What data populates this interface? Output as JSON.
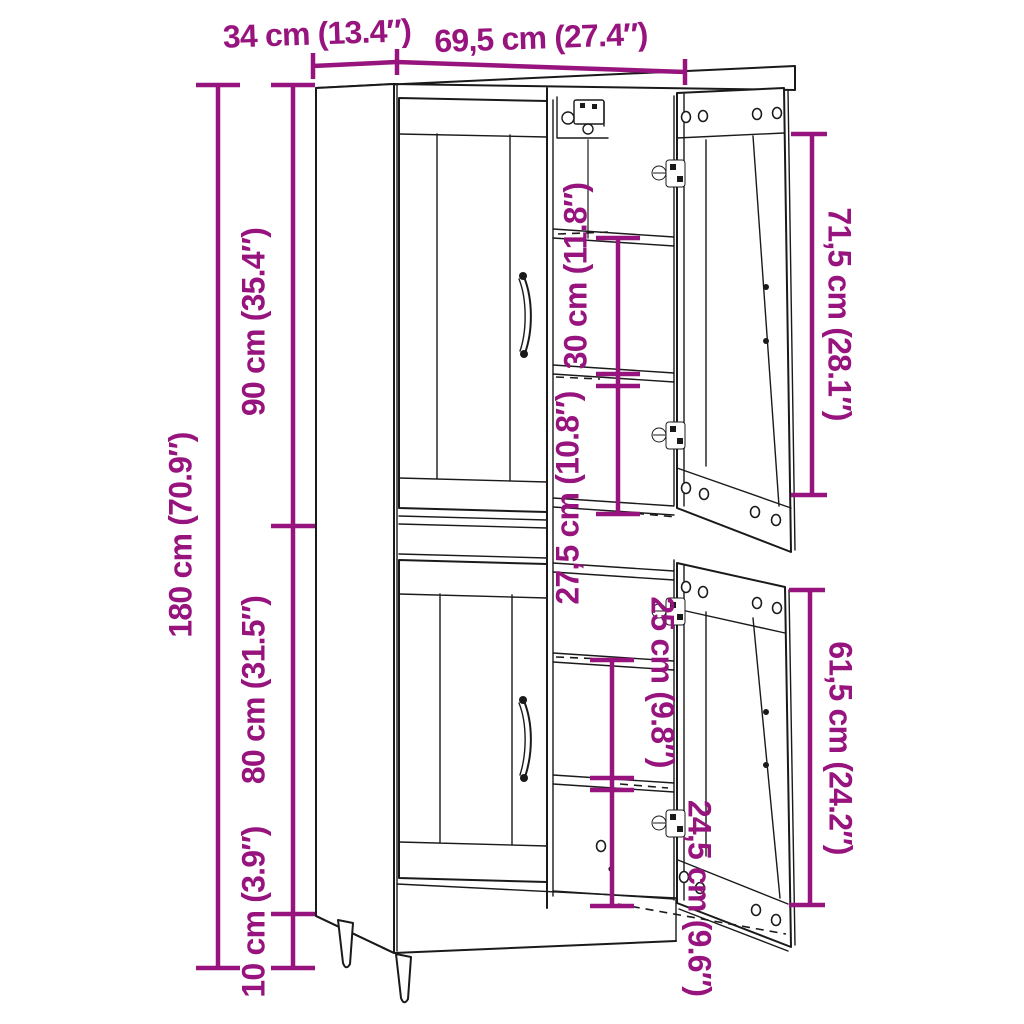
{
  "diagram": {
    "colors": {
      "dimension": "#97137D",
      "line": "#1a1a1a",
      "background": "#ffffff"
    },
    "dimensions": {
      "depth": "34 cm (13.4″)",
      "width": "69,5 cm (27.4″)",
      "total_height": "180 cm (70.9″)",
      "upper_section_height": "90 cm (35.4″)",
      "lower_section_height": "80 cm (31.5″)",
      "leg_height": "10 cm (3.9″)",
      "upper_shelf_spacing": "30 cm (11.8″)",
      "upper_lower_compartment": "27,5 cm (10.8″)",
      "lower_shelf_spacing": "25 cm (9.8″)",
      "lower_bottom_compartment": "24,5 cm (9.6″)",
      "upper_door_height": "71,5 cm (28.1″)",
      "lower_door_height": "61,5 cm (24.2″)"
    }
  }
}
